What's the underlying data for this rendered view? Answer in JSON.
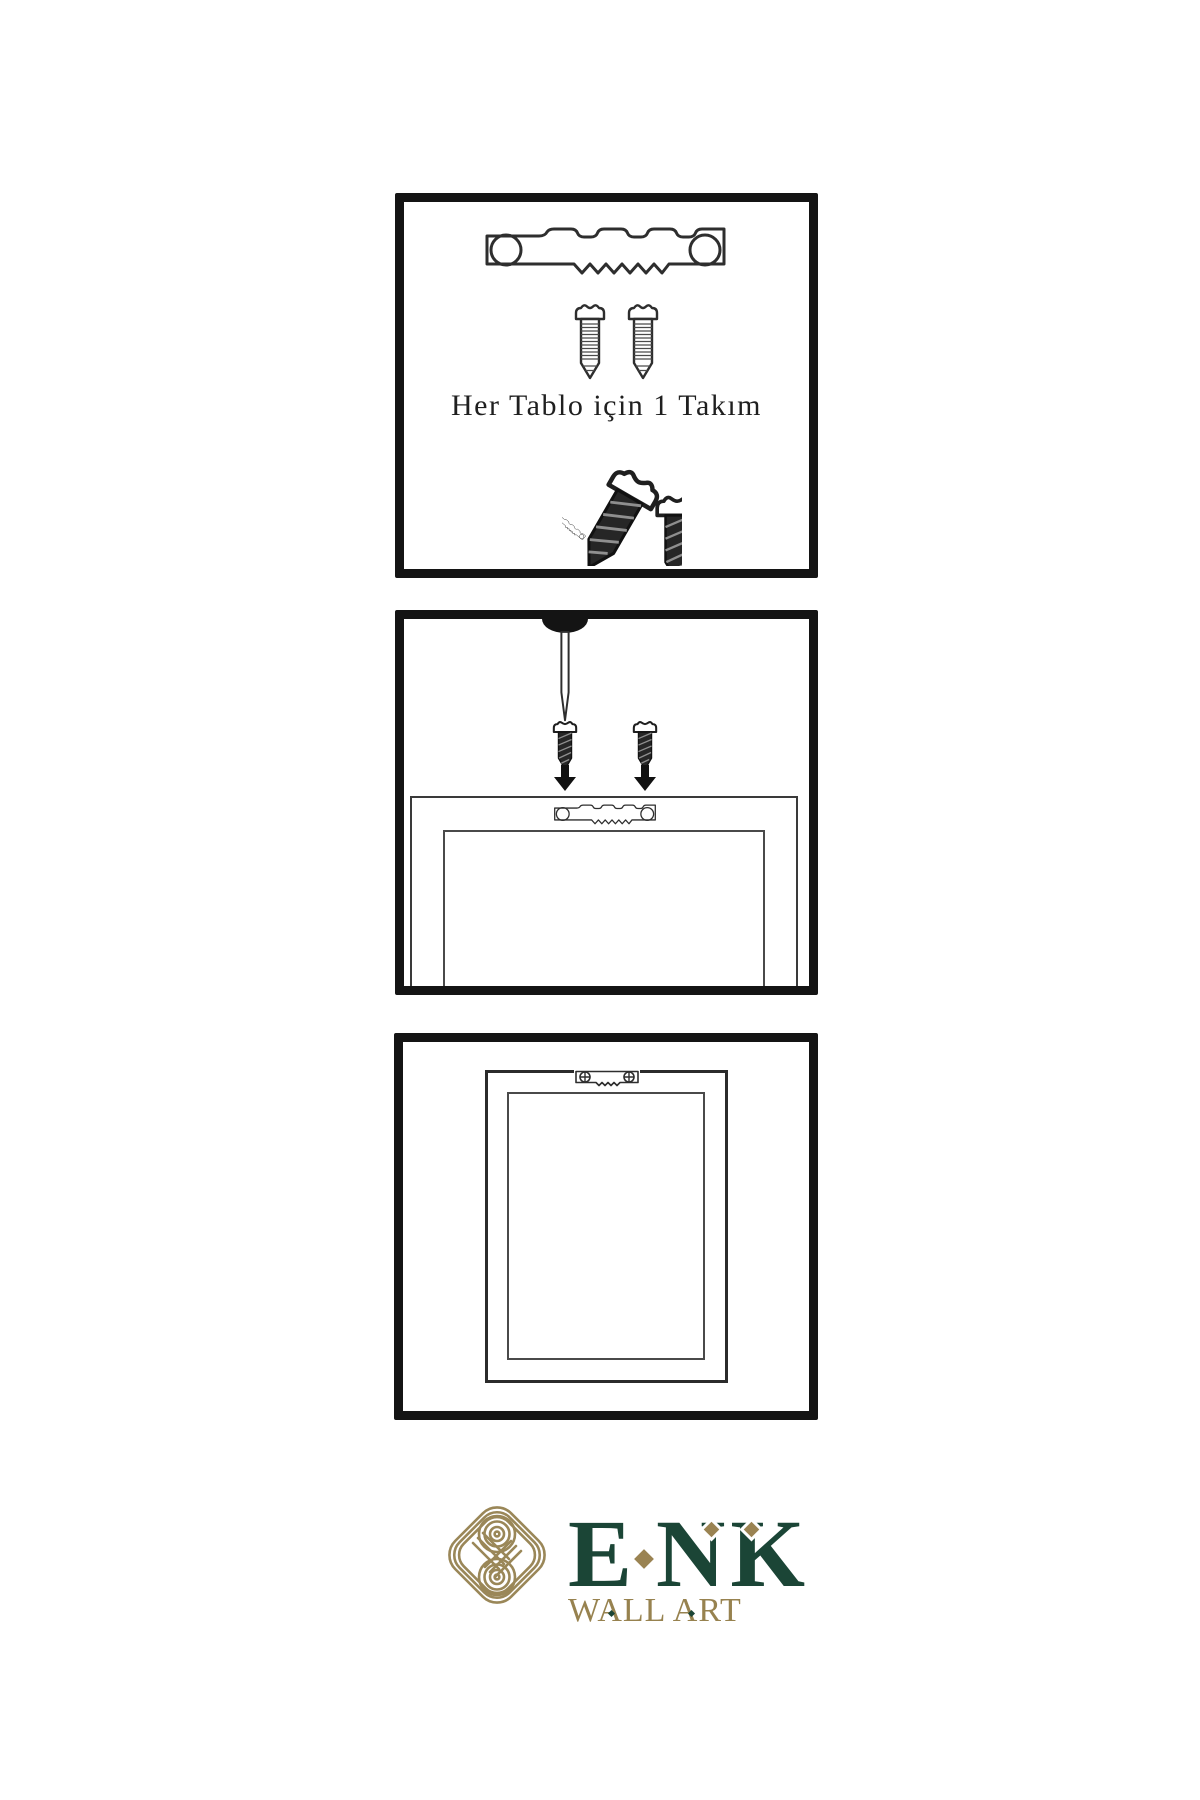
{
  "sheet": {
    "background": "#ffffff",
    "panel_border_color": "#141414",
    "line_art_color": "#2e2e2e"
  },
  "panels": [
    {
      "name": "hardware-kit",
      "caption": "Her Tablo için 1 Takım",
      "icons": [
        "sawtooth-hanger-icon",
        "screw-icon",
        "screw-icon",
        "tilted-screw-icon",
        "tilted-hanger-icon",
        "small-screw-icon"
      ]
    },
    {
      "name": "attach-hanger-to-frame",
      "icons": [
        "wall-nail-icon",
        "dark-screw-icon",
        "dark-screw-icon",
        "arrow-down-icon",
        "arrow-down-icon",
        "frame-back-icon",
        "sawtooth-hanger-icon"
      ]
    },
    {
      "name": "hang-frame-on-wall",
      "icons": [
        "frame-front-icon",
        "mounted-hanger-with-screws-icon"
      ]
    }
  ],
  "logo": {
    "brand": "ENK",
    "letters": [
      "E",
      "N",
      "K"
    ],
    "tagline": "WALL ART",
    "knot_icon": "interlaced-knot-icon",
    "colors": {
      "brand_green": "#1b4536",
      "gold": "#9a8352",
      "tagline_gold": "#97824f"
    }
  }
}
